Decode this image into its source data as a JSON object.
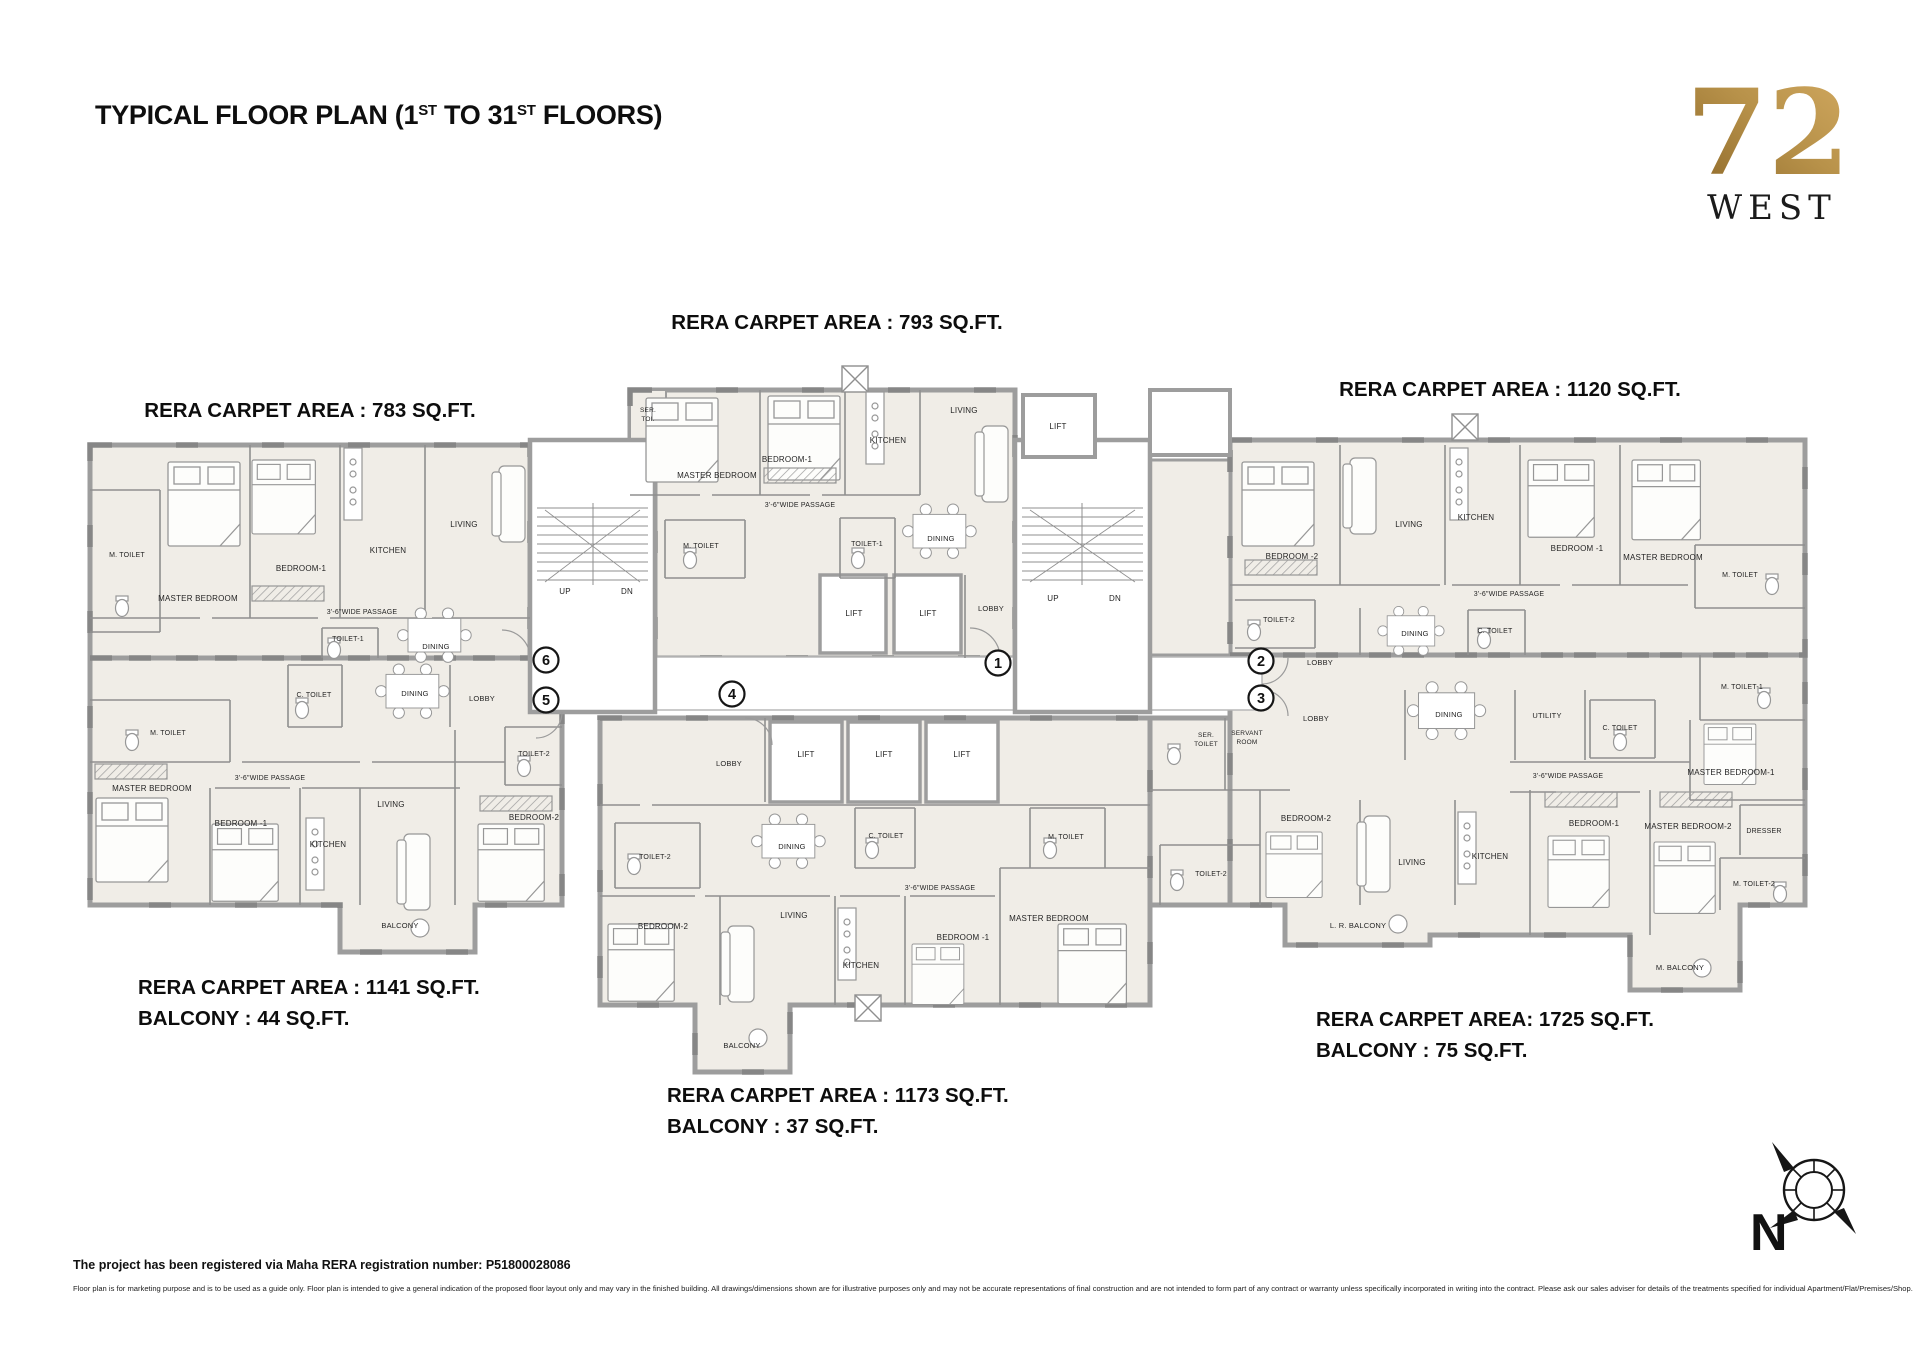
{
  "title": {
    "parts": [
      "TYPICAL FLOOR PLAN  (1",
      "ST",
      " TO 31",
      "ST",
      " FLOORS)"
    ]
  },
  "logo": {
    "number": "72",
    "word": "WEST",
    "gold_dark": "#8a6526",
    "gold_light": "#cfa55e"
  },
  "area_labels": [
    {
      "id": "unit-783",
      "anchor": "middle",
      "x": 310,
      "y": 417,
      "lines": [
        "RERA CARPET AREA : 783 SQ.FT."
      ]
    },
    {
      "id": "unit-793",
      "anchor": "middle",
      "x": 837,
      "y": 329,
      "lines": [
        "RERA CARPET AREA : 793 SQ.FT."
      ]
    },
    {
      "id": "unit-1120",
      "anchor": "middle",
      "x": 1510,
      "y": 396,
      "lines": [
        "RERA CARPET AREA : 1120 SQ.FT."
      ]
    },
    {
      "id": "unit-1141",
      "anchor": "start",
      "x": 138,
      "y": 994,
      "lines": [
        "RERA CARPET AREA : 1141 SQ.FT.",
        "BALCONY : 44 SQ.FT."
      ]
    },
    {
      "id": "unit-1173",
      "anchor": "start",
      "x": 667,
      "y": 1102,
      "lines": [
        "RERA CARPET AREA : 1173 SQ.FT.",
        "BALCONY : 37 SQ.FT."
      ]
    },
    {
      "id": "unit-1725",
      "anchor": "start",
      "x": 1316,
      "y": 1026,
      "lines": [
        "RERA CARPET AREA: 1725 SQ.FT.",
        "BALCONY : 75 SQ.FT."
      ]
    }
  ],
  "circled_numbers": [
    {
      "n": "1",
      "x": 998,
      "y": 663
    },
    {
      "n": "2",
      "x": 1261,
      "y": 661
    },
    {
      "n": "3",
      "x": 1261,
      "y": 698
    },
    {
      "n": "4",
      "x": 732,
      "y": 694
    },
    {
      "n": "5",
      "x": 546,
      "y": 700
    },
    {
      "n": "6",
      "x": 546,
      "y": 660
    }
  ],
  "rooms": [
    {
      "t": "M. TOILET",
      "x": 127,
      "y": 557,
      "s": 7
    },
    {
      "t": "MASTER BEDROOM",
      "x": 198,
      "y": 601
    },
    {
      "t": "BEDROOM-1",
      "x": 301,
      "y": 571
    },
    {
      "t": "KITCHEN",
      "x": 388,
      "y": 553
    },
    {
      "t": "LIVING",
      "x": 464,
      "y": 527
    },
    {
      "t": "3'-6\"WIDE PASSAGE",
      "x": 362,
      "y": 614,
      "s": 7
    },
    {
      "t": "TOILET-1",
      "x": 348,
      "y": 641,
      "s": 7
    },
    {
      "t": "DINING",
      "x": 436,
      "y": 649,
      "s": 7.5
    },
    {
      "t": "UP",
      "x": 565,
      "y": 594,
      "s": 8
    },
    {
      "t": "DN",
      "x": 627,
      "y": 594,
      "s": 8
    },
    {
      "t": "SER.",
      "x": 648,
      "y": 412,
      "s": 6.5
    },
    {
      "t": "TOI.",
      "x": 648,
      "y": 421,
      "s": 6.5
    },
    {
      "t": "MASTER BEDROOM",
      "x": 717,
      "y": 478
    },
    {
      "t": "BEDROOM-1",
      "x": 787,
      "y": 462
    },
    {
      "t": "KITCHEN",
      "x": 888,
      "y": 443
    },
    {
      "t": "LIVING",
      "x": 964,
      "y": 413
    },
    {
      "t": "LIFT",
      "x": 1058,
      "y": 429
    },
    {
      "t": "3'-6\"WIDE PASSAGE",
      "x": 800,
      "y": 507,
      "s": 7
    },
    {
      "t": "M. TOILET",
      "x": 701,
      "y": 548,
      "s": 7
    },
    {
      "t": "TOILET-1",
      "x": 867,
      "y": 546,
      "s": 7
    },
    {
      "t": "DINING",
      "x": 941,
      "y": 541,
      "s": 7.5
    },
    {
      "t": "LIFT",
      "x": 854,
      "y": 616
    },
    {
      "t": "LIFT",
      "x": 928,
      "y": 616
    },
    {
      "t": "LOBBY",
      "x": 991,
      "y": 611,
      "s": 7.5
    },
    {
      "t": "UP",
      "x": 1053,
      "y": 601,
      "s": 8
    },
    {
      "t": "DN",
      "x": 1115,
      "y": 601,
      "s": 8
    },
    {
      "t": "M. TOILET",
      "x": 168,
      "y": 735,
      "s": 7
    },
    {
      "t": "C. TOILET",
      "x": 314,
      "y": 697,
      "s": 7
    },
    {
      "t": "DINING",
      "x": 415,
      "y": 696,
      "s": 7.5
    },
    {
      "t": "LOBBY",
      "x": 482,
      "y": 701,
      "s": 7.5
    },
    {
      "t": "TOILET-2",
      "x": 534,
      "y": 756,
      "s": 7
    },
    {
      "t": "MASTER BEDROOM",
      "x": 152,
      "y": 791
    },
    {
      "t": "3'-6\"WIDE PASSAGE",
      "x": 270,
      "y": 780,
      "s": 7
    },
    {
      "t": "BEDROOM -1",
      "x": 241,
      "y": 826
    },
    {
      "t": "KITCHEN",
      "x": 328,
      "y": 847
    },
    {
      "t": "LIVING",
      "x": 391,
      "y": 807
    },
    {
      "t": "BEDROOM-2",
      "x": 534,
      "y": 820
    },
    {
      "t": "BALCONY",
      "x": 400,
      "y": 928,
      "s": 7.5
    },
    {
      "t": "LOBBY",
      "x": 729,
      "y": 766,
      "s": 7.5
    },
    {
      "t": "LIFT",
      "x": 806,
      "y": 757
    },
    {
      "t": "LIFT",
      "x": 884,
      "y": 757
    },
    {
      "t": "LIFT",
      "x": 962,
      "y": 757
    },
    {
      "t": "DINING",
      "x": 792,
      "y": 849,
      "s": 7.5
    },
    {
      "t": "C. TOILET",
      "x": 886,
      "y": 838,
      "s": 7
    },
    {
      "t": "M. TOILET",
      "x": 1066,
      "y": 839,
      "s": 7
    },
    {
      "t": "TOILET-2",
      "x": 655,
      "y": 859,
      "s": 7
    },
    {
      "t": "3'-6\"WIDE PASSAGE",
      "x": 940,
      "y": 890,
      "s": 7
    },
    {
      "t": "BEDROOM-2",
      "x": 663,
      "y": 929
    },
    {
      "t": "LIVING",
      "x": 794,
      "y": 918
    },
    {
      "t": "KITCHEN",
      "x": 861,
      "y": 968
    },
    {
      "t": "BEDROOM -1",
      "x": 963,
      "y": 940
    },
    {
      "t": "MASTER BEDROOM",
      "x": 1049,
      "y": 921
    },
    {
      "t": "BALCONY",
      "x": 742,
      "y": 1048,
      "s": 7.5
    },
    {
      "t": "BEDROOM -2",
      "x": 1292,
      "y": 559
    },
    {
      "t": "LIVING",
      "x": 1409,
      "y": 527
    },
    {
      "t": "KITCHEN",
      "x": 1476,
      "y": 520
    },
    {
      "t": "BEDROOM -1",
      "x": 1577,
      "y": 551
    },
    {
      "t": "MASTER BEDROOM",
      "x": 1663,
      "y": 560
    },
    {
      "t": "TOILET-2",
      "x": 1279,
      "y": 622,
      "s": 7
    },
    {
      "t": "3'-6\"WIDE PASSAGE",
      "x": 1509,
      "y": 596,
      "s": 7
    },
    {
      "t": "M. TOILET",
      "x": 1740,
      "y": 577,
      "s": 7
    },
    {
      "t": "DINING",
      "x": 1415,
      "y": 636,
      "s": 7.5
    },
    {
      "t": "C. TOILET",
      "x": 1495,
      "y": 633,
      "s": 7
    },
    {
      "t": "LOBBY",
      "x": 1320,
      "y": 665,
      "s": 7.5
    },
    {
      "t": "LOBBY",
      "x": 1316,
      "y": 721,
      "s": 7.5
    },
    {
      "t": "DINING",
      "x": 1449,
      "y": 717,
      "s": 7.5
    },
    {
      "t": "UTILITY",
      "x": 1547,
      "y": 718,
      "s": 7.5
    },
    {
      "t": "C. TOILET",
      "x": 1620,
      "y": 730,
      "s": 7
    },
    {
      "t": "M. TOILET-1",
      "x": 1742,
      "y": 689,
      "s": 7
    },
    {
      "t": "SER.",
      "x": 1206,
      "y": 737,
      "s": 6.5
    },
    {
      "t": "TOILET",
      "x": 1206,
      "y": 746,
      "s": 6.5
    },
    {
      "t": "SERVANT",
      "x": 1247,
      "y": 735,
      "s": 6.5
    },
    {
      "t": "ROOM",
      "x": 1247,
      "y": 744,
      "s": 6.5
    },
    {
      "t": "TOILET-2",
      "x": 1211,
      "y": 876,
      "s": 7
    },
    {
      "t": "BEDROOM-2",
      "x": 1306,
      "y": 821
    },
    {
      "t": "LIVING",
      "x": 1412,
      "y": 865
    },
    {
      "t": "KITCHEN",
      "x": 1490,
      "y": 859
    },
    {
      "t": "3'-6\"WIDE PASSAGE",
      "x": 1568,
      "y": 778,
      "s": 7
    },
    {
      "t": "MASTER BEDROOM-1",
      "x": 1731,
      "y": 775
    },
    {
      "t": "BEDROOM-1",
      "x": 1594,
      "y": 826
    },
    {
      "t": "MASTER BEDROOM-2",
      "x": 1688,
      "y": 829
    },
    {
      "t": "DRESSER",
      "x": 1764,
      "y": 833,
      "s": 7
    },
    {
      "t": "M. TOILET-2",
      "x": 1754,
      "y": 886,
      "s": 7
    },
    {
      "t": "L. R. BALCONY",
      "x": 1358,
      "y": 928,
      "s": 7.5
    },
    {
      "t": "M. BALCONY",
      "x": 1680,
      "y": 970,
      "s": 7.5
    }
  ],
  "footer": {
    "registration": "The project has been registered via Maha RERA registration number: P51800028086",
    "disclaimer": "Floor plan is for marketing purpose and is to be used as a guide only. Floor plan is intended to give a general indication of the proposed floor layout only and may vary in the finished building. All drawings/dimensions shown are for illustrative purposes only and may not be accurate representations of final construction and are not intended to form part of any contract or warranty unless specifically incorporated in writing into the contract. Please ask our sales adviser for details of the treatments specified for individual Apartment/Flat/Premises/Shop."
  },
  "compass": {
    "label": "N"
  }
}
